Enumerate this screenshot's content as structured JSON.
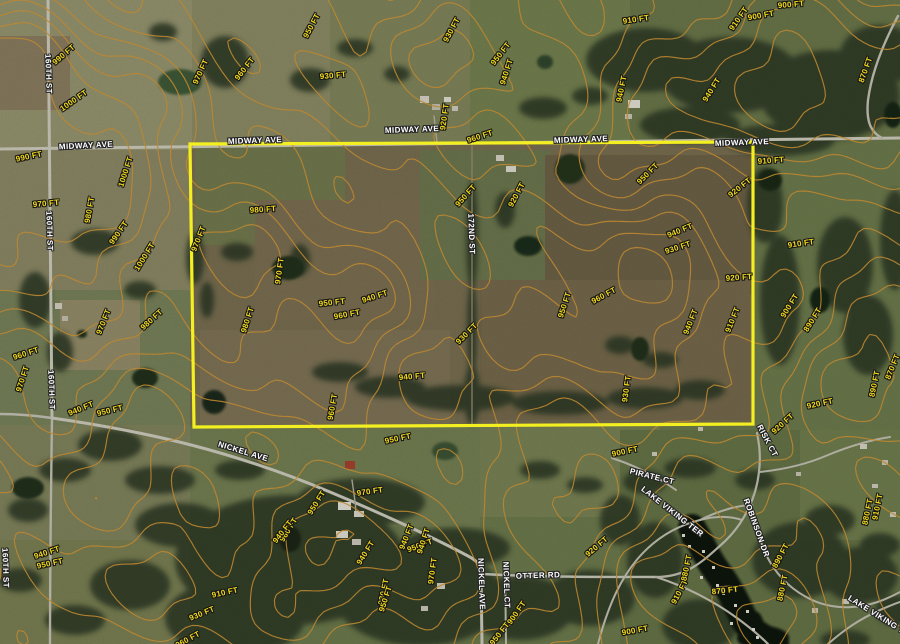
{
  "map": {
    "description": "Aerial parcel map with topographic contour overlay",
    "colors": {
      "boundary": "#f3ef20",
      "contour_line": "#bd8731",
      "contour_label": "#f2da1b",
      "road_label": "#ffffff"
    },
    "contour_interval_ft": 10,
    "elevation_range_ft": [
      860,
      1000
    ],
    "parcel": {
      "points": "190,144 753,142 753,424 194,427"
    },
    "road_labels": [
      {
        "text": "MIDWAY AVE",
        "x": 86,
        "y": 146,
        "rot": -3
      },
      {
        "text": "MIDWAY AVE",
        "x": 255,
        "y": 141,
        "rot": -2
      },
      {
        "text": "MIDWAY AVE",
        "x": 412,
        "y": 130,
        "rot": -2
      },
      {
        "text": "MIDWAY AVE",
        "x": 581,
        "y": 140,
        "rot": -2
      },
      {
        "text": "MIDWAY AVE",
        "x": 742,
        "y": 143,
        "rot": -2
      },
      {
        "text": "160TH ST",
        "x": 48,
        "y": 74,
        "rot": 88
      },
      {
        "text": "160TH ST",
        "x": 49,
        "y": 231,
        "rot": 88
      },
      {
        "text": "160TH ST",
        "x": 51,
        "y": 390,
        "rot": 88
      },
      {
        "text": "160TH ST",
        "x": 5,
        "y": 568,
        "rot": 88
      },
      {
        "text": "172ND ST",
        "x": 471,
        "y": 234,
        "rot": 88
      },
      {
        "text": "NICKEL AVE",
        "x": 243,
        "y": 452,
        "rot": 17
      },
      {
        "text": "NICKEL AVE",
        "x": 481,
        "y": 584,
        "rot": 88
      },
      {
        "text": "NICKEL CT",
        "x": 506,
        "y": 585,
        "rot": 88
      },
      {
        "text": "OTTER RD",
        "x": 538,
        "y": 576,
        "rot": -2
      },
      {
        "text": "PIRATE CT",
        "x": 652,
        "y": 477,
        "rot": 14
      },
      {
        "text": "RISK CT",
        "x": 767,
        "y": 441,
        "rot": 62
      },
      {
        "text": "LAKE VIKING TER",
        "x": 672,
        "y": 512,
        "rot": 38
      },
      {
        "text": "ROBINSON DR",
        "x": 756,
        "y": 528,
        "rot": 70
      },
      {
        "text": "LAKE VIKING TER",
        "x": 881,
        "y": 618,
        "rot": 32
      }
    ],
    "contour_labels": [
      {
        "text": "990 FT",
        "x": 64,
        "y": 55,
        "rot": -40
      },
      {
        "text": "1000 FT",
        "x": 74,
        "y": 101,
        "rot": -35
      },
      {
        "text": "990 FT",
        "x": 29,
        "y": 157,
        "rot": -12
      },
      {
        "text": "1000 FT",
        "x": 126,
        "y": 172,
        "rot": -72
      },
      {
        "text": "970 FT",
        "x": 46,
        "y": 204,
        "rot": -5
      },
      {
        "text": "980 FT",
        "x": 90,
        "y": 210,
        "rot": -80
      },
      {
        "text": "990 FT",
        "x": 119,
        "y": 233,
        "rot": -55
      },
      {
        "text": "1000 FT",
        "x": 145,
        "y": 257,
        "rot": -58
      },
      {
        "text": "970 FT",
        "x": 199,
        "y": 239,
        "rot": -68
      },
      {
        "text": "970 FT",
        "x": 201,
        "y": 72,
        "rot": -65
      },
      {
        "text": "960 FT",
        "x": 245,
        "y": 69,
        "rot": -52
      },
      {
        "text": "980 FT",
        "x": 263,
        "y": 210,
        "rot": -4
      },
      {
        "text": "930 FT",
        "x": 333,
        "y": 76,
        "rot": -5
      },
      {
        "text": "950 FT",
        "x": 312,
        "y": 26,
        "rot": -62
      },
      {
        "text": "930 FT",
        "x": 452,
        "y": 30,
        "rot": -62
      },
      {
        "text": "950 FT",
        "x": 501,
        "y": 54,
        "rot": -52
      },
      {
        "text": "940 FT",
        "x": 507,
        "y": 72,
        "rot": -72
      },
      {
        "text": "920 FT",
        "x": 445,
        "y": 117,
        "rot": -82
      },
      {
        "text": "960 FT",
        "x": 480,
        "y": 137,
        "rot": -18
      },
      {
        "text": "910 FT",
        "x": 636,
        "y": 20,
        "rot": -8
      },
      {
        "text": "910 FT",
        "x": 739,
        "y": 19,
        "rot": -55
      },
      {
        "text": "900 FT",
        "x": 761,
        "y": 16,
        "rot": -10
      },
      {
        "text": "900 FT",
        "x": 791,
        "y": 5,
        "rot": -5
      },
      {
        "text": "870 FT",
        "x": 866,
        "y": 70,
        "rot": -70
      },
      {
        "text": "940 FT",
        "x": 622,
        "y": 89,
        "rot": -78
      },
      {
        "text": "940 FT",
        "x": 712,
        "y": 90,
        "rot": -58
      },
      {
        "text": "910 FT",
        "x": 771,
        "y": 161,
        "rot": -4
      },
      {
        "text": "950 FT",
        "x": 648,
        "y": 174,
        "rot": -45
      },
      {
        "text": "920 FT",
        "x": 740,
        "y": 188,
        "rot": -38
      },
      {
        "text": "920 FT",
        "x": 517,
        "y": 195,
        "rot": -62
      },
      {
        "text": "950 FT",
        "x": 466,
        "y": 196,
        "rot": -48
      },
      {
        "text": "970 FT",
        "x": 280,
        "y": 271,
        "rot": -82
      },
      {
        "text": "950 FT",
        "x": 332,
        "y": 303,
        "rot": -6
      },
      {
        "text": "940 FT",
        "x": 375,
        "y": 297,
        "rot": -18
      },
      {
        "text": "960 FT",
        "x": 347,
        "y": 315,
        "rot": -10
      },
      {
        "text": "980 FT",
        "x": 248,
        "y": 320,
        "rot": -72
      },
      {
        "text": "940 FT",
        "x": 680,
        "y": 231,
        "rot": -22
      },
      {
        "text": "930 FT",
        "x": 678,
        "y": 248,
        "rot": -18
      },
      {
        "text": "920 FT",
        "x": 739,
        "y": 278,
        "rot": -4
      },
      {
        "text": "910 FT",
        "x": 801,
        "y": 244,
        "rot": -8
      },
      {
        "text": "900 FT",
        "x": 790,
        "y": 306,
        "rot": -58
      },
      {
        "text": "890 FT",
        "x": 813,
        "y": 320,
        "rot": -58
      },
      {
        "text": "910 FT",
        "x": 733,
        "y": 320,
        "rot": -68
      },
      {
        "text": "960 FT",
        "x": 604,
        "y": 296,
        "rot": -28
      },
      {
        "text": "950 FT",
        "x": 565,
        "y": 305,
        "rot": -72
      },
      {
        "text": "940 FT",
        "x": 691,
        "y": 322,
        "rot": -68
      },
      {
        "text": "930 FT",
        "x": 467,
        "y": 334,
        "rot": -45
      },
      {
        "text": "960 FT",
        "x": 333,
        "y": 407,
        "rot": -80
      },
      {
        "text": "940 FT",
        "x": 412,
        "y": 377,
        "rot": -5
      },
      {
        "text": "930 FT",
        "x": 627,
        "y": 389,
        "rot": -82
      },
      {
        "text": "920 FT",
        "x": 783,
        "y": 424,
        "rot": -42
      },
      {
        "text": "920 FT",
        "x": 820,
        "y": 404,
        "rot": -12
      },
      {
        "text": "870 FT",
        "x": 893,
        "y": 367,
        "rot": -68
      },
      {
        "text": "890 FT",
        "x": 875,
        "y": 384,
        "rot": -78
      },
      {
        "text": "920 FT",
        "x": 597,
        "y": 547,
        "rot": -40
      },
      {
        "text": "900 FT",
        "x": 625,
        "y": 452,
        "rot": -12
      },
      {
        "text": "900 FT",
        "x": 517,
        "y": 613,
        "rot": -55
      },
      {
        "text": "950 FT",
        "x": 500,
        "y": 634,
        "rot": -52
      },
      {
        "text": "970 FT",
        "x": 433,
        "y": 571,
        "rot": -82
      },
      {
        "text": "930 FT",
        "x": 384,
        "y": 592,
        "rot": -78
      },
      {
        "text": "950 FT",
        "x": 420,
        "y": 546,
        "rot": -20
      },
      {
        "text": "950 FT",
        "x": 398,
        "y": 439,
        "rot": -12
      },
      {
        "text": "970 FT",
        "x": 370,
        "y": 492,
        "rot": -8
      },
      {
        "text": "950 FT",
        "x": 317,
        "y": 503,
        "rot": -58
      },
      {
        "text": "960 FT",
        "x": 289,
        "y": 530,
        "rot": -58
      },
      {
        "text": "940 FT",
        "x": 407,
        "y": 537,
        "rot": -68
      },
      {
        "text": "940 FT",
        "x": 424,
        "y": 541,
        "rot": -72
      },
      {
        "text": "940 FT",
        "x": 366,
        "y": 553,
        "rot": -58
      },
      {
        "text": "950 FT",
        "x": 386,
        "y": 599,
        "rot": -72
      },
      {
        "text": "940 FT",
        "x": 81,
        "y": 409,
        "rot": -22
      },
      {
        "text": "950 FT",
        "x": 110,
        "y": 411,
        "rot": -14
      },
      {
        "text": "940 FT",
        "x": 47,
        "y": 553,
        "rot": -18
      },
      {
        "text": "950 FT",
        "x": 50,
        "y": 564,
        "rot": -12
      },
      {
        "text": "910 FT",
        "x": 225,
        "y": 593,
        "rot": -12
      },
      {
        "text": "930 FT",
        "x": 202,
        "y": 614,
        "rot": -22
      },
      {
        "text": "940 FT",
        "x": 283,
        "y": 532,
        "rot": -52
      },
      {
        "text": "960 FT",
        "x": 188,
        "y": 640,
        "rot": -28
      },
      {
        "text": "900 FT",
        "x": 635,
        "y": 631,
        "rot": -10
      },
      {
        "text": "870 FT",
        "x": 725,
        "y": 591,
        "rot": -6
      },
      {
        "text": "910 FT",
        "x": 680,
        "y": 592,
        "rot": -62
      },
      {
        "text": "880 FT",
        "x": 687,
        "y": 568,
        "rot": -78
      },
      {
        "text": "890 FT",
        "x": 781,
        "y": 556,
        "rot": -62
      },
      {
        "text": "880 FT",
        "x": 783,
        "y": 588,
        "rot": -78
      },
      {
        "text": "880 FT",
        "x": 868,
        "y": 512,
        "rot": -78
      },
      {
        "text": "910 FT",
        "x": 878,
        "y": 507,
        "rot": -78
      },
      {
        "text": "980 FT",
        "x": 152,
        "y": 320,
        "rot": -42
      },
      {
        "text": "970 FT",
        "x": 104,
        "y": 322,
        "rot": -68
      },
      {
        "text": "960 FT",
        "x": 26,
        "y": 354,
        "rot": -18
      },
      {
        "text": "970 FT",
        "x": 23,
        "y": 379,
        "rot": -72
      }
    ]
  }
}
